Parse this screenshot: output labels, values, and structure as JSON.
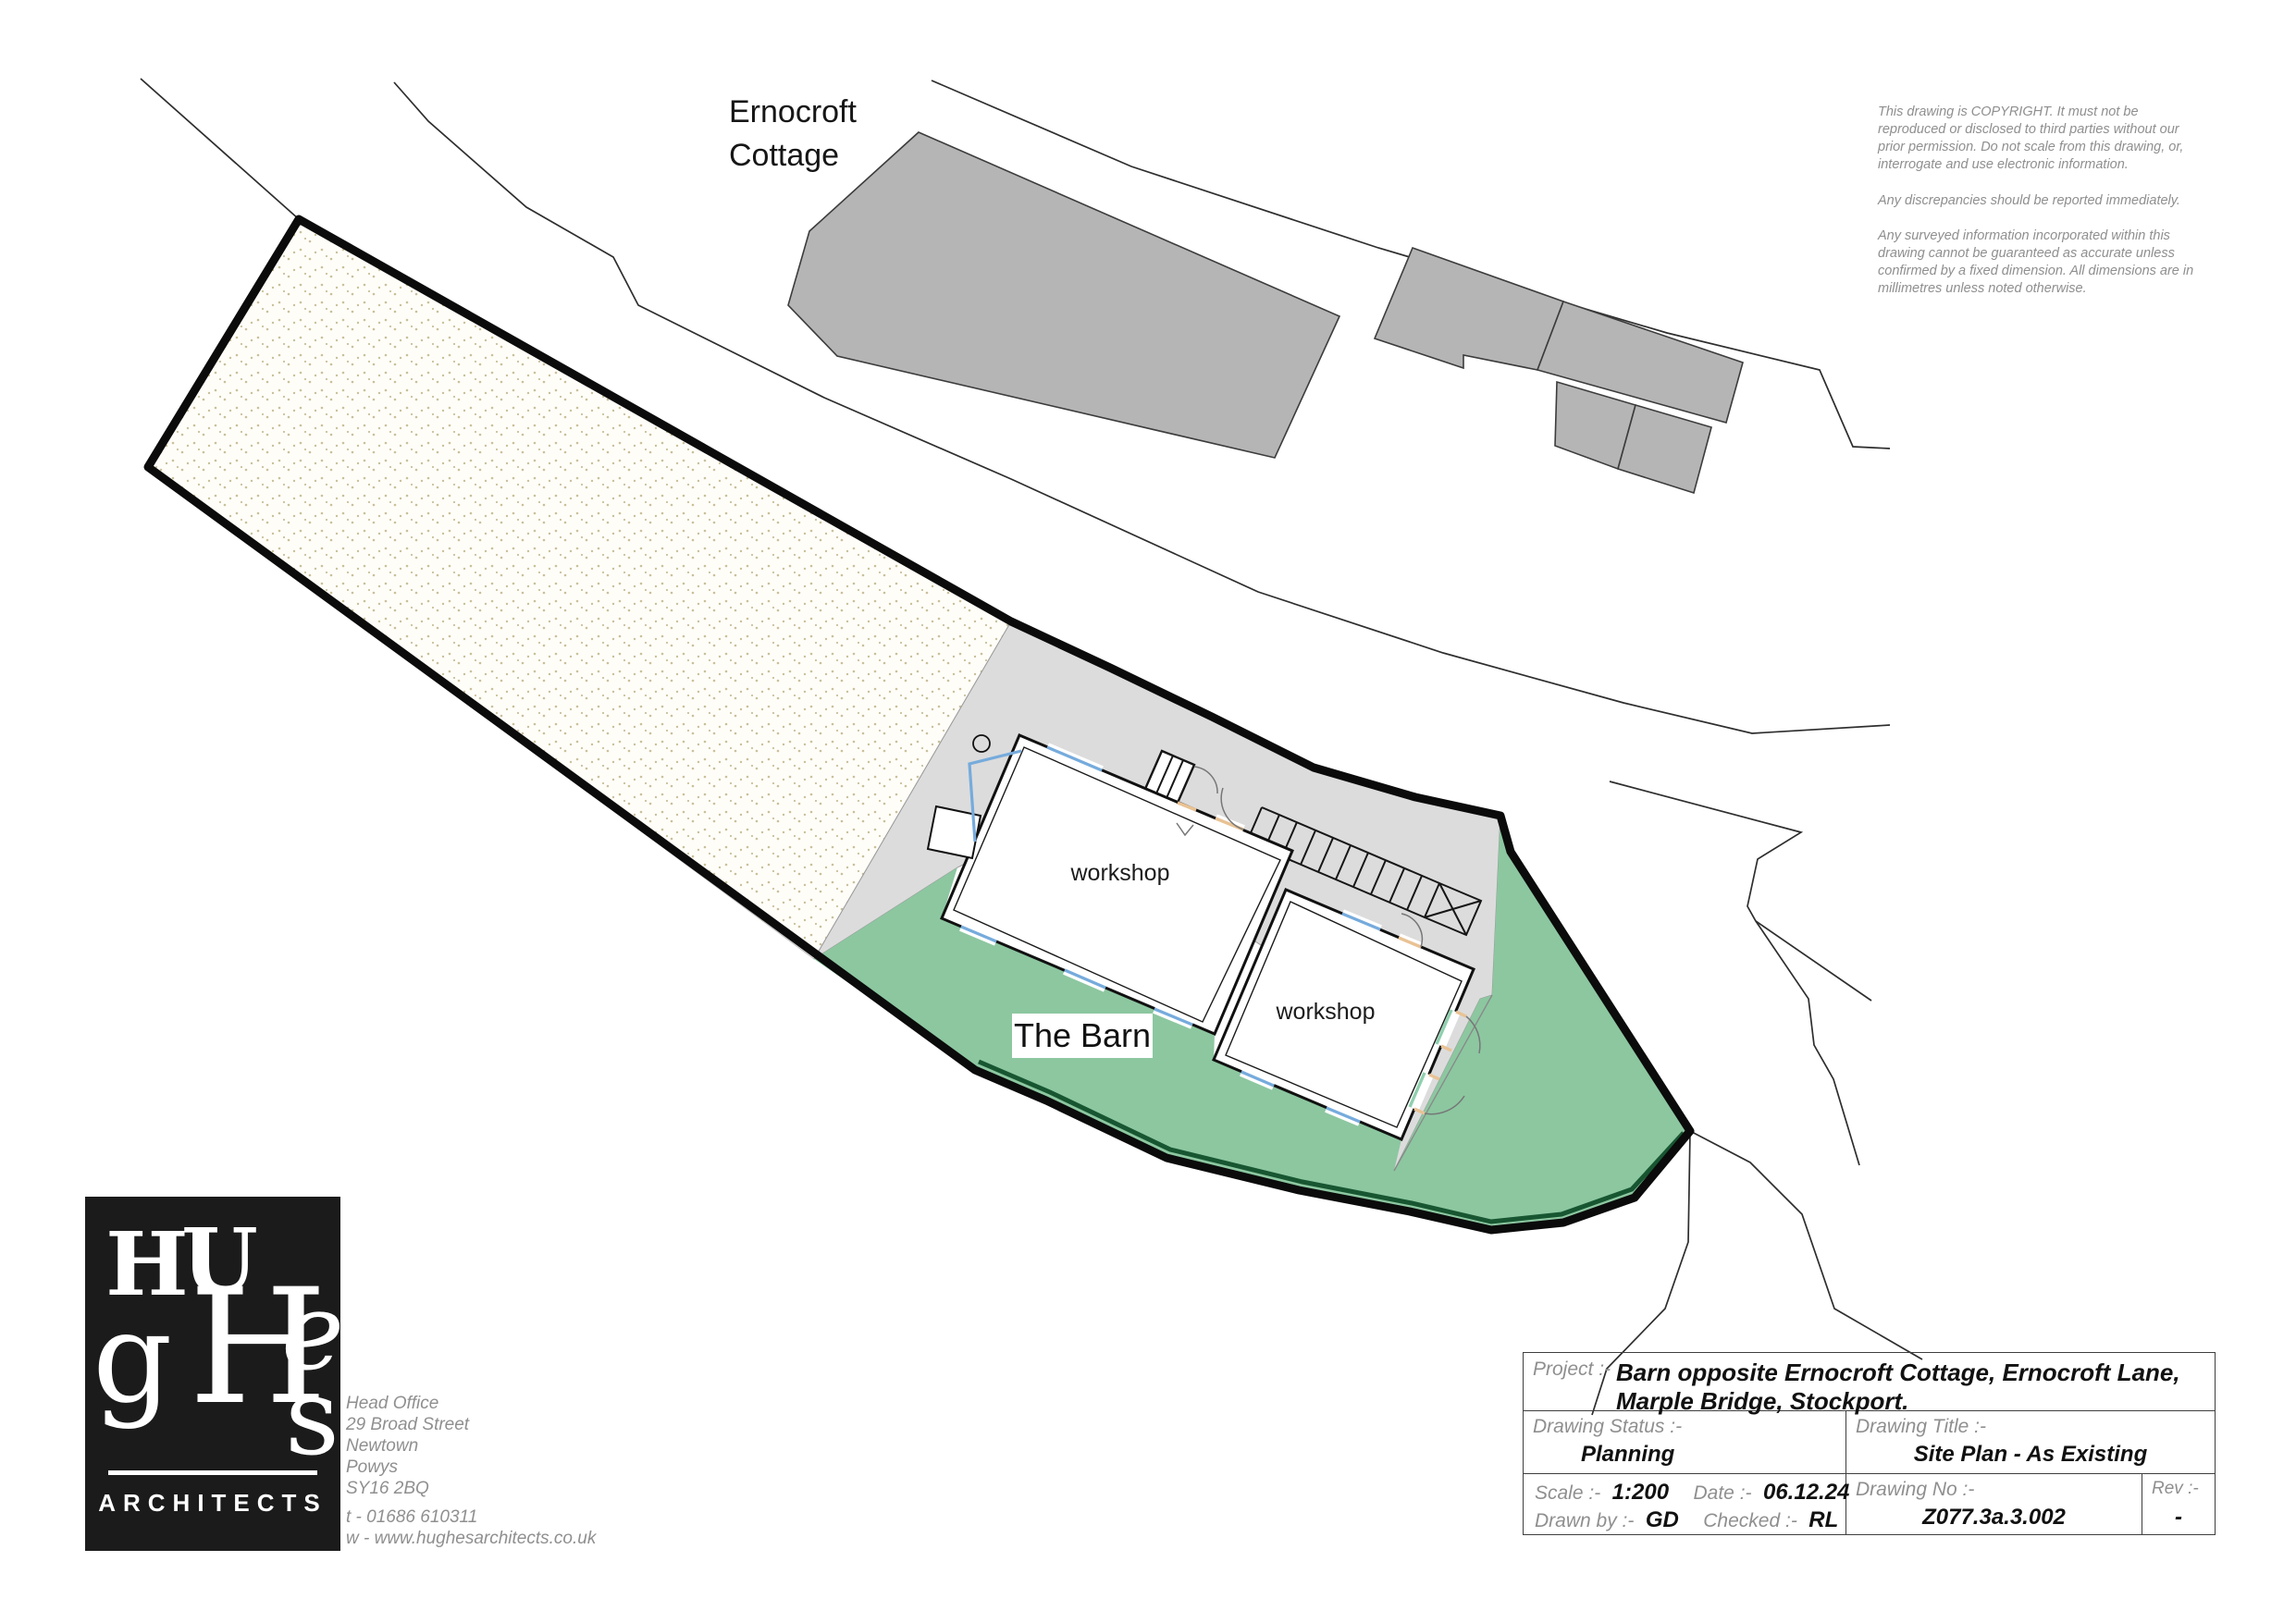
{
  "colors": {
    "grass": "#8cc7a0",
    "grass_shadow": "#175631",
    "driveway": "#dcdcdc",
    "building_gray": "#b5b5b5",
    "stipple_dot": "#c9c09b",
    "window_blue": "#76abdc",
    "door_orange": "#e9c294",
    "door_green": "#8fd0ae",
    "boundary": "#0b0b0b",
    "road_line": "#2e2e2e"
  },
  "plan": {
    "cottage_label_line1": "Ernocroft",
    "cottage_label_line2": "Cottage",
    "barn_label": "The Barn",
    "workshop_label_1": "workshop",
    "workshop_label_2": "workshop"
  },
  "copyright": {
    "para1": "This drawing is COPYRIGHT. It must not be reproduced or disclosed to third parties without our prior permission. Do not scale from this drawing, or, interrogate and use electronic information.",
    "para2": "Any discrepancies should be reported immediately.",
    "para3": "Any surveyed information incorporated within this drawing cannot be guaranteed as accurate unless confirmed by a fixed dimension. All dimensions are in millimetres unless noted otherwise."
  },
  "logo": {
    "letter_h1": "H",
    "letter_u": "U",
    "letter_g": "g",
    "letter_h2": "H",
    "letter_e": "e",
    "letter_s": "s",
    "architects": "ARCHITECTS"
  },
  "office": {
    "line1": "Head Office",
    "line2": "29 Broad Street",
    "line3": "Newtown",
    "line4": "Powys",
    "line5": "SY16 2BQ",
    "tel": "t - 01686 610311",
    "web": "w - www.hughesarchitects.co.uk"
  },
  "title_block": {
    "project_label": "Project :-",
    "project_value_line1": "Barn opposite Ernocroft Cottage, Ernocroft Lane,",
    "project_value_line2": "Marple Bridge, Stockport.",
    "status_label": "Drawing Status :-",
    "status_value": "Planning",
    "title_label": "Drawing Title :-",
    "title_value": "Site Plan - As Existing",
    "scale_label": "Scale :-",
    "scale_value": "1:200",
    "date_label": "Date :-",
    "date_value": "06.12.24",
    "drawn_label": "Drawn by :-",
    "drawn_value": "GD",
    "checked_label": "Checked :-",
    "checked_value": "RL",
    "drawing_no_label": "Drawing No :-",
    "drawing_no_value": "Z077.3a.3.002",
    "rev_label": "Rev :-",
    "rev_value": "-"
  }
}
